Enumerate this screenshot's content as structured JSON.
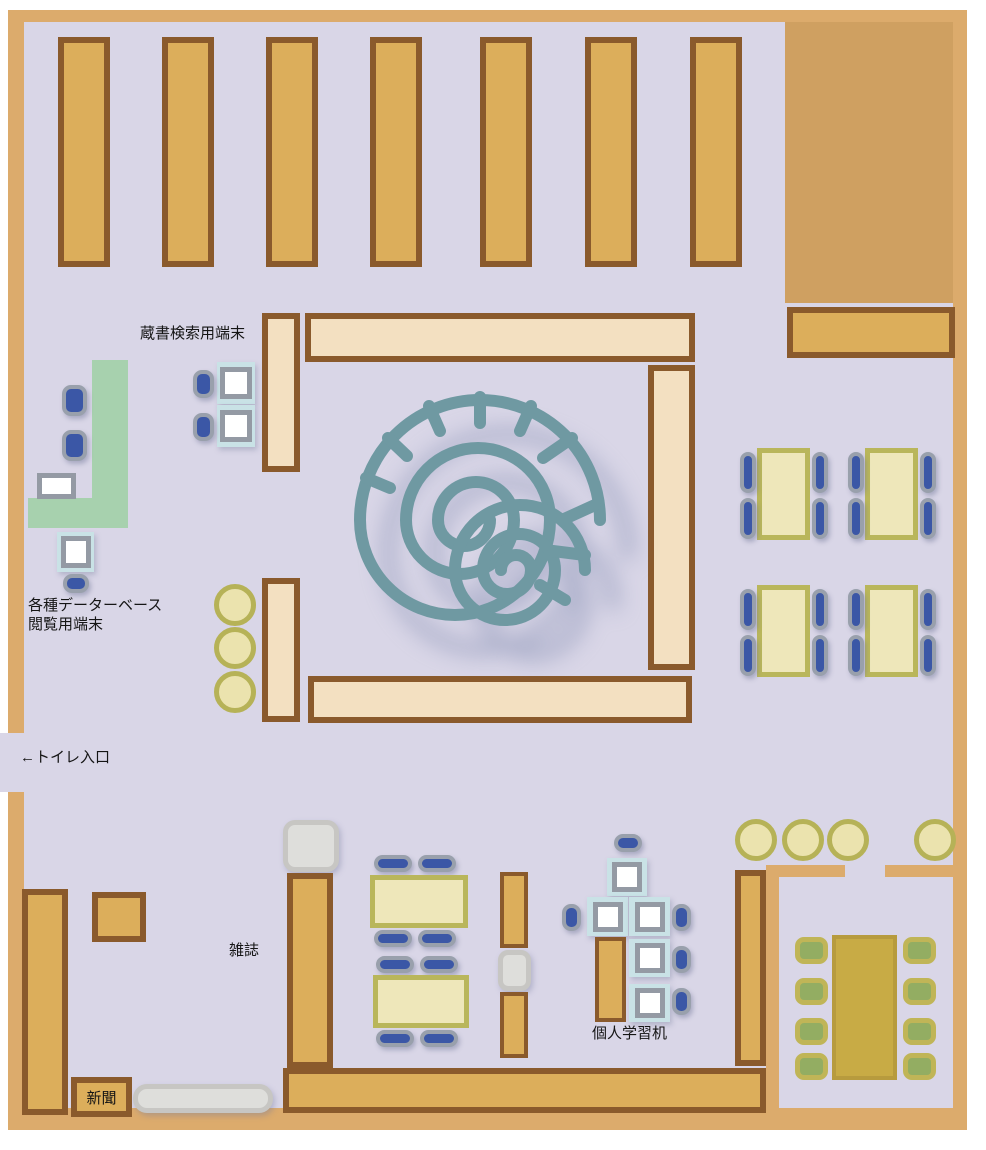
{
  "labels": {
    "catalog_terminals": "蔵書検索用端末",
    "database_terminals_line1": "各種データーベース",
    "database_terminals_line2": "閲覧用端末",
    "toilet_entrance": "←トイレ入口",
    "magazines": "雑誌",
    "newspapers": "新聞",
    "study_desks": "個人学習机"
  },
  "colors": {
    "floor": "#d9d6e7",
    "wall": "#dcab6c",
    "wall_block": "#cfa061",
    "bookshelf_fill": "#dcae5b",
    "bookshelf_border": "#8a5a2c",
    "counter_shelf_fill": "#f3e0c1",
    "service_counter_green": "#a7d1ae",
    "table_fill": "#eee7ba",
    "table_border": "#b9b65b",
    "chair_blue": "#3b57a6",
    "chair_green": "#93ad62",
    "terminal_desk_blue": "#c9e2e6",
    "monitor_white": "#ffffff",
    "stool_fill": "#ebe3ae",
    "stool_border": "#b6b257",
    "meeting_table": "#c8ab45",
    "bench_gray": "#dededb",
    "spiral_art": "#6f99a2",
    "spiral_shadow": "#7f89ae"
  }
}
